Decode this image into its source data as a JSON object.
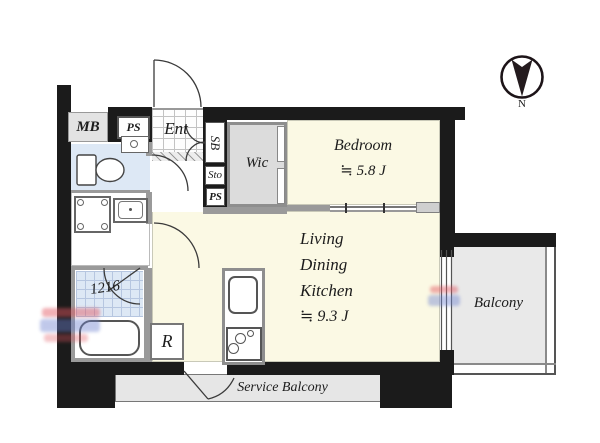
{
  "colors": {
    "wall": "#1b1b1b",
    "room-cream": "#fbf9e4",
    "wet-blue": "#dde8f5",
    "closet-gray": "#dcdcdc",
    "balcony-gray": "#e9e9e9",
    "service-gray": "#e6e6e6",
    "partition-gray": "#9a9a9a",
    "text": "#1c1c1c",
    "wm-red": "#e25560",
    "wm-blue": "#6b7fd0"
  },
  "labels": {
    "meter_box": "MB",
    "pipe_space_top": "PS",
    "entrance": "Ent",
    "shoe_box": "SB",
    "storage": "Sto",
    "pipe_space": "PS",
    "walk_in_closet": "Wic",
    "bath_unit_size": "1216",
    "refrigerator": "R",
    "north": "N"
  },
  "rooms": {
    "bedroom": {
      "name": "Bedroom",
      "size": "≒ 5.8 J"
    },
    "ldk": {
      "line1": "Living",
      "line2": "Dining",
      "line3": "Kitchen",
      "size": "≒ 9.3 J"
    },
    "balcony": {
      "name": "Balcony"
    },
    "service_balcony": {
      "name": "Service Balcony"
    }
  }
}
